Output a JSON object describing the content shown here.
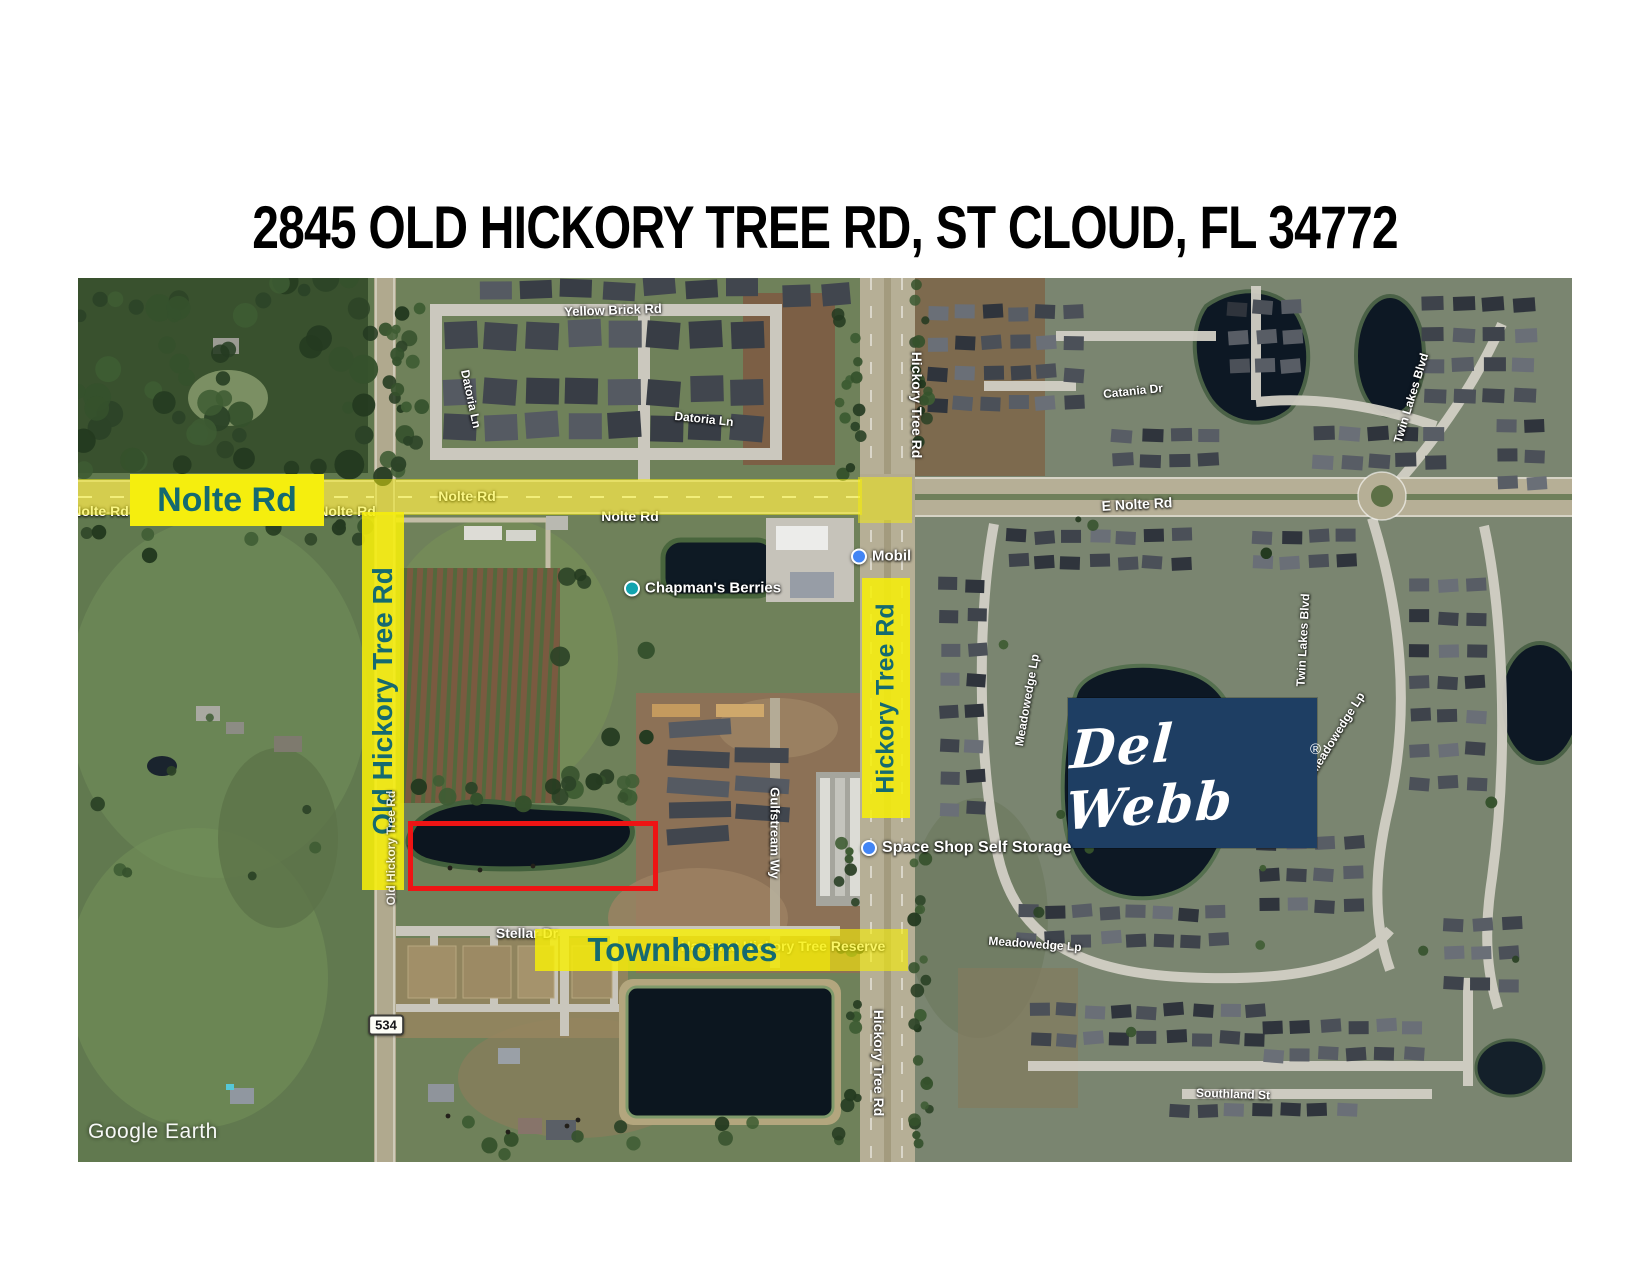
{
  "title": "2845 OLD HICKORY TREE RD, ST CLOUD, FL 34772",
  "map": {
    "attribution": "Google Earth",
    "route_shield": "534",
    "colors": {
      "highlight_yellow": "#f5ee0e",
      "highlight_text_teal": "#156a70",
      "property_outline_red": "#ee1414",
      "delwebb_navy": "#1e3e63",
      "pin_blue": "#4285f4",
      "pin_teal": "#12a4af"
    },
    "highlights": {
      "nolte": "Nolte Rd",
      "old_hickory": "Old Hickory Tree Rd",
      "hickory": "Hickory Tree Rd",
      "townhomes": "Townhomes"
    },
    "delwebb": {
      "text": "Del Webb",
      "reg": "®"
    },
    "road_labels": [
      {
        "text": "Nolte Rd",
        "x": 100,
        "y": 511,
        "size": 14
      },
      {
        "text": "Nolte Rd",
        "x": 347,
        "y": 511,
        "size": 14
      },
      {
        "text": "Nolte Rd",
        "x": 467,
        "y": 496,
        "size": 14
      },
      {
        "text": "Nolte Rd",
        "x": 630,
        "y": 516,
        "size": 14
      },
      {
        "text": "E Nolte Rd",
        "x": 1137,
        "y": 504,
        "size": 14,
        "rot": -3
      },
      {
        "text": "Yellow Brick Rd",
        "x": 613,
        "y": 310,
        "size": 13,
        "rot": -2
      },
      {
        "text": "Datoria Ln",
        "x": 471,
        "y": 399,
        "size": 12,
        "rot": 78
      },
      {
        "text": "Datoria Ln",
        "x": 704,
        "y": 419,
        "size": 12,
        "rot": 6
      },
      {
        "text": "Old Hickory Tree Rd",
        "x": 391,
        "y": 848,
        "size": 12,
        "rot": -90,
        "over": true,
        "opacity": 0.8
      },
      {
        "text": "Hickory Tree Rd",
        "x": 917,
        "y": 405,
        "size": 14,
        "rot": 90
      },
      {
        "text": "Hickory Tree Rd",
        "x": 879,
        "y": 1063,
        "size": 14,
        "rot": 90
      },
      {
        "text": "Stellar Dr",
        "x": 527,
        "y": 933,
        "size": 14
      },
      {
        "text": "Gulfstream Wy",
        "x": 775,
        "y": 833,
        "size": 13,
        "rot": 90
      },
      {
        "text": "Haven at Hickory Tree Reserve",
        "x": 783,
        "y": 946,
        "size": 14
      },
      {
        "text": "Meadowedge Lp",
        "x": 1027,
        "y": 700,
        "size": 12,
        "rot": -80
      },
      {
        "text": "Meadowedge Lp",
        "x": 1337,
        "y": 733,
        "size": 12,
        "rot": -58
      },
      {
        "text": "Meadowedge Lp",
        "x": 1035,
        "y": 944,
        "size": 12,
        "rot": 4
      },
      {
        "text": "Catania Dr",
        "x": 1133,
        "y": 391,
        "size": 12,
        "rot": -6
      },
      {
        "text": "Twin Lakes Blvd",
        "x": 1411,
        "y": 398,
        "size": 12,
        "rot": -73
      },
      {
        "text": "Twin Lakes Blvd",
        "x": 1303,
        "y": 640,
        "size": 12,
        "rot": -87
      },
      {
        "text": "Southland St",
        "x": 1233,
        "y": 1094,
        "size": 12,
        "rot": 2
      }
    ],
    "places": [
      {
        "label": "Chapman's Berries",
        "x": 630,
        "y": 588,
        "size": 15,
        "pin": "teal"
      },
      {
        "label": "Mobil",
        "x": 857,
        "y": 556,
        "size": 15,
        "pin": "blue"
      },
      {
        "label": "Space Shop Self Storage",
        "x": 867,
        "y": 848,
        "size": 16,
        "pin": "blue"
      }
    ]
  }
}
